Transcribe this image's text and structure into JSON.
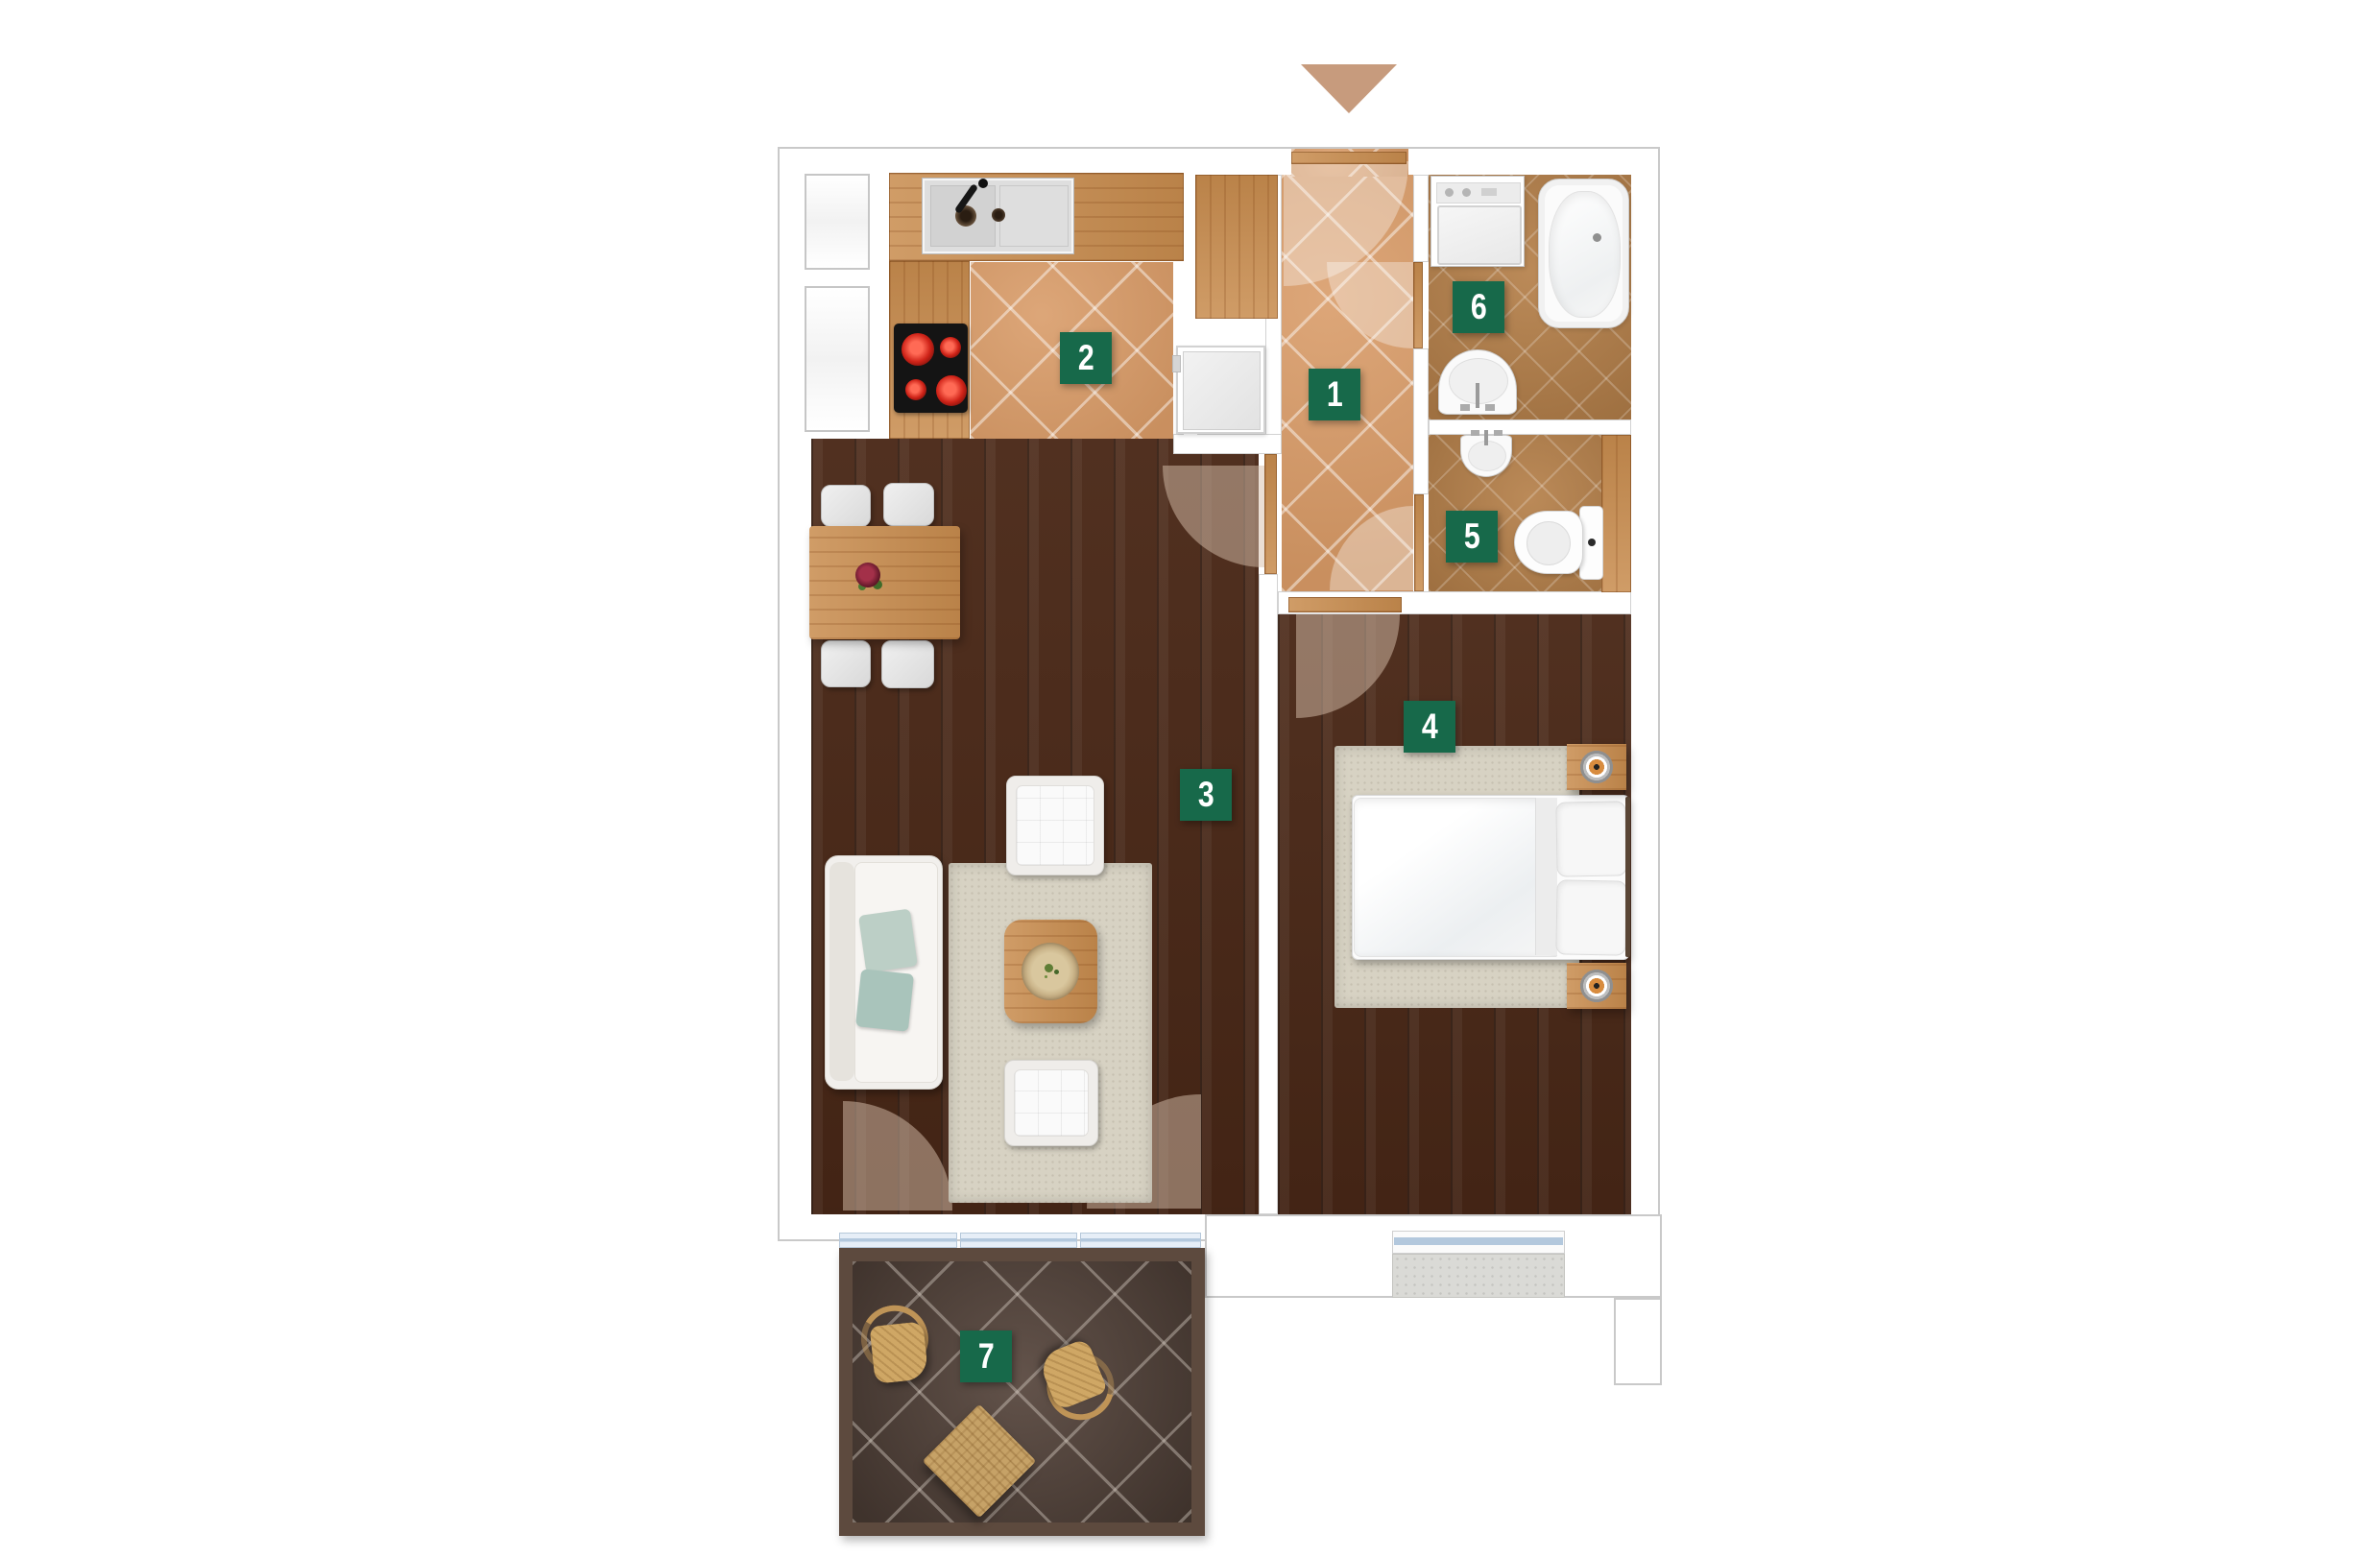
{
  "rooms": [
    {
      "number": "1",
      "name": "hallway"
    },
    {
      "number": "2",
      "name": "kitchen"
    },
    {
      "number": "3",
      "name": "living-room"
    },
    {
      "number": "4",
      "name": "bedroom"
    },
    {
      "number": "5",
      "name": "toilet"
    },
    {
      "number": "6",
      "name": "bathroom"
    },
    {
      "number": "7",
      "name": "balcony"
    }
  ],
  "entrance": {
    "marker": "arrow-down"
  },
  "colors": {
    "label-green": "#17694a",
    "label-text": "#ffffff",
    "arrow-tan": "#c79b7d",
    "tile-light": "#d89a66",
    "tile-dark": "#b5804a",
    "wood-floor": "#4a2817",
    "wood-furniture": "#c88c4e",
    "balcony-tile": "#57463d",
    "balcony-border": "#5d4a3e",
    "wall-outline": "#c9c9c9",
    "glass-blue": "#b3c8dd"
  }
}
